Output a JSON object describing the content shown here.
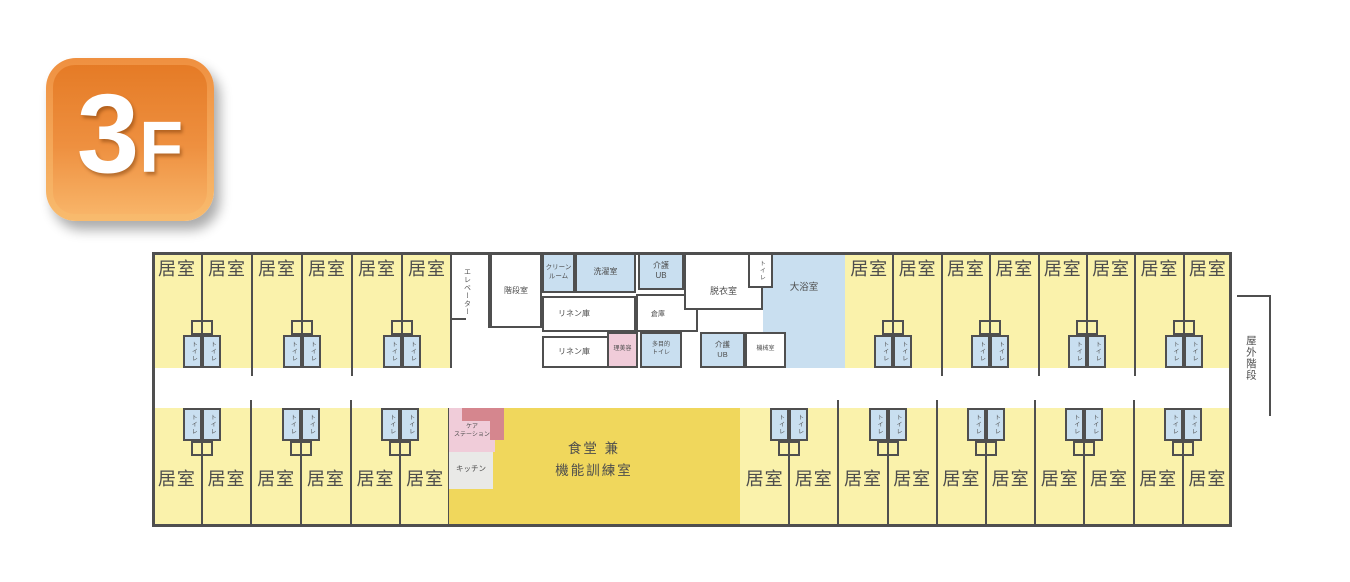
{
  "floor_badge": {
    "number": "3",
    "suffix": "F"
  },
  "plan": {
    "labels": {
      "room": "居室",
      "toilet": "トイレ",
      "elevator": "エレベーター",
      "stairwell": "階段室",
      "clean_room": "クリーン\nルーム",
      "laundry_room": "洗濯室",
      "linen_storage_1": "リネン庫",
      "linen_storage_2": "リネン庫",
      "care_unit_bath_top": "介護\nUB",
      "storage": "倉庫",
      "dressing_room": "脱衣室",
      "bath_toilet": "トイレ",
      "large_bath": "大浴室",
      "beauty_salon": "理美容",
      "multipurpose_toilet": "多目的\nトイレ",
      "care_unit_bath_bottom": "介護\nUB",
      "machine_room": "機械室",
      "care_station": "ケア\nステーション",
      "kitchen": "キッチン",
      "dining": "食堂 兼\n機能訓練室",
      "outdoor_stairs": "屋外階段"
    },
    "room_counts": {
      "top_left": 6,
      "top_right": 8,
      "bottom_left": 6,
      "bottom_right": 10
    },
    "colors": {
      "wall": "#4f4f4f",
      "room_fill": "#faf2ab",
      "dining_fill": "#f0d75c",
      "wet_area_fill": "#c9dff0",
      "pink_fill": "#f0ccd9",
      "counter_accent": "#d5868e",
      "kitchen_fill": "#e9e9e7",
      "label_text": "#4d4d4d",
      "badge_text": "#ffffff",
      "badge_orange_top": "#e57b26",
      "badge_orange_bottom": "#f8b468"
    }
  }
}
